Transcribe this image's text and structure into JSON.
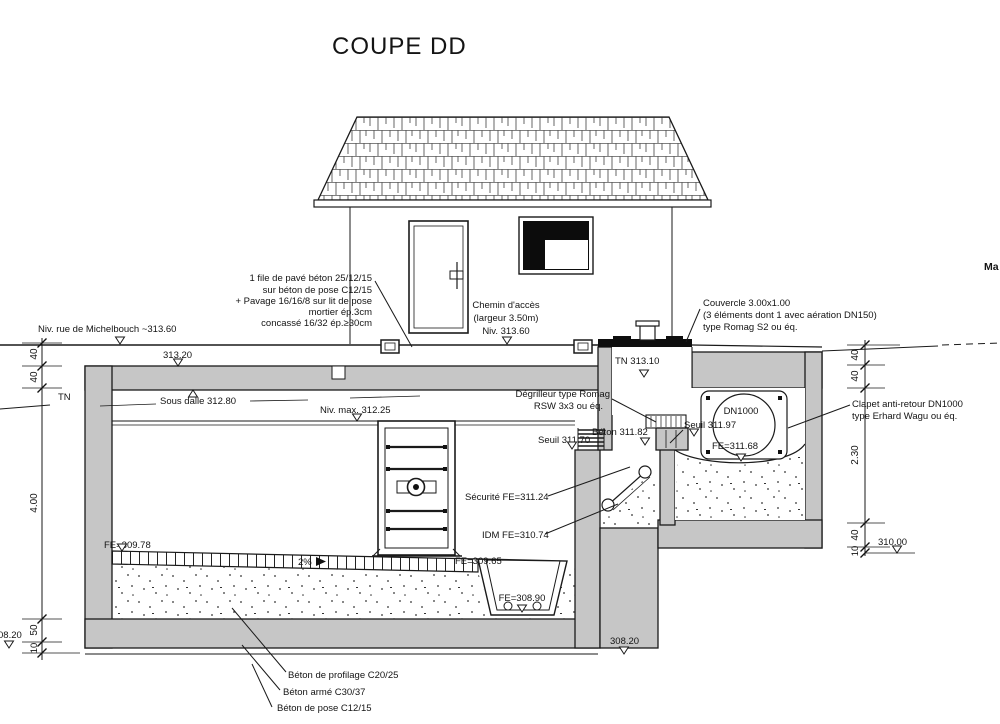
{
  "title": "COUPE DD",
  "ann": {
    "pave": [
      "1 file de pavé béton 25/12/15",
      "sur béton de pose C12/15",
      "+ Pavage 16/16/8 sur lit de pose",
      "mortier ép.3cm",
      "concassé 16/32 ép.≥30cm"
    ],
    "niv_rue": "Niv. rue de Michelbouch ~313.60",
    "lvl_313_20": "313.20",
    "tn_left": "TN",
    "chemin": [
      "Chemin d'accès",
      "(largeur 3.50m)",
      "Niv. 313.60"
    ],
    "couvercle": [
      "Couvercle 3.00x1.00",
      "(3 éléments dont 1 avec aération DN150)",
      "type Romag S2 ou éq."
    ],
    "tn_shaft": "TN  313.10",
    "sous_dalle": "Sous dalle 312.80",
    "niv_max": "Niv. max. 312.25",
    "degrilleur": [
      "Dégrilleur type Romag",
      "RSW 3x3 ou éq."
    ],
    "seuil_311_70": "Seuil 311.70",
    "beton_311_82": "Béton 311.82",
    "seuil_311_97": "Seuil 311.97",
    "dn1000": "DN1000",
    "fe_311_68": "FE=311.68",
    "clapet": [
      "Clapet anti-retour DN1000",
      "type Erhard Wagu ou éq."
    ],
    "securite": "Sécurité FE=311.24",
    "idm": "IDM FE=310.74",
    "fe_309_78": "FE=309.78",
    "fe_309_65": "FE=309.65",
    "slope": "2%",
    "fe_308_90": "FE=308.90",
    "lvl_308_20_right": "308.20",
    "lvl_308_20_left": "08.20",
    "lvl_310_00": "310.00",
    "edge_truncated": "Ma",
    "notes_bottom": [
      "Béton de profilage C20/25",
      "Béton armé C30/37",
      "Béton de pose C12/15"
    ]
  },
  "dims": {
    "left": [
      "40",
      "40",
      "4.00",
      "50",
      "10"
    ],
    "right": [
      "40",
      "40",
      "2.30",
      "40",
      "10"
    ]
  }
}
